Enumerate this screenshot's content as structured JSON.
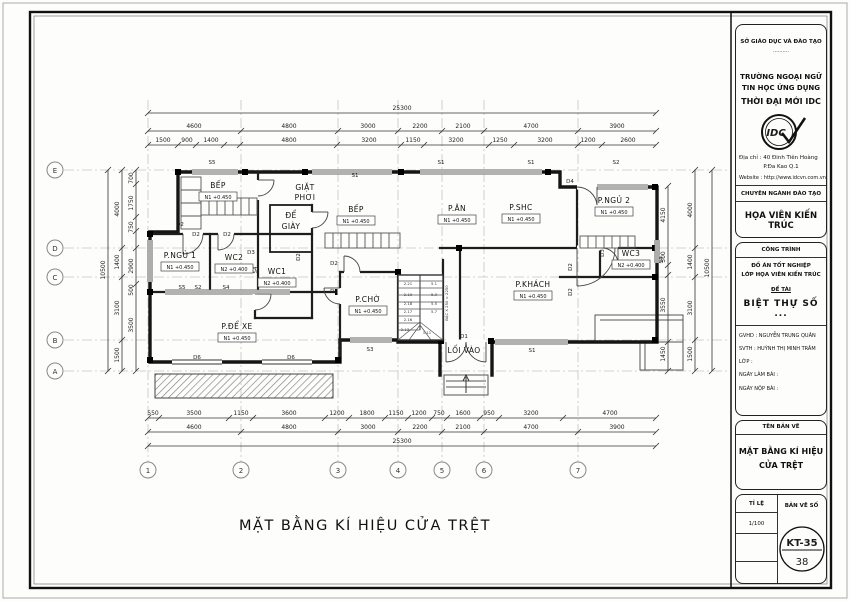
{
  "sheet": {
    "drawing_title": "MẶT BẰNG KÍ HIỆU CỬA TRỆT"
  },
  "title_block": {
    "dept": "SỞ GIÁO DỤC VÀ ĐÀO TẠO",
    "dots": "..........",
    "school_line1": "TRƯỜNG NGOẠI NGỮ",
    "school_line2": "TIN HỌC ỨNG DỤNG",
    "school_line3": "THỜI ĐẠI MỚI IDC",
    "logo_text": "IDC",
    "address_line1": "Địa chỉ : 40 Đinh Tiên Hoàng",
    "address_line2": "P.Đa Kao    Q.1",
    "website": "Website : http://www.idcvn.com.vn",
    "major_header": "CHUYÊN NGÀNH ĐÀO TẠO",
    "major": "HỌA VIÊN KIẾN TRÚC",
    "project_header": "CÔNG TRÌNH",
    "project_line1": "ĐỒ ÁN TỐT NGHIỆP",
    "project_line2": "LỚP HỌA VIÊN KIẾN TRÚC",
    "topic_header": "ĐỀ TÀI",
    "topic": "BIỆT THỰ SỐ ...",
    "gvhd": "GVHD   : NGUYỄN TRUNG QUÂN",
    "svth": "SVTH   : HUỲNH THỊ MINH TRÂM",
    "lop": "LỚP      :",
    "ngay_lam": "NGÀY LÀM BÀI  :",
    "ngay_nop": "NGÀY NỘP BÀI  :",
    "drawing_name_header": "TÊN BẢN VẼ",
    "drawing_name_line1": "MẶT BẰNG KÍ HIỆU",
    "drawing_name_line2": "CỬA TRỆT",
    "scale_header": "TỈ LỆ",
    "scale": "1/100",
    "sheet_no_header": "BẢN VẼ SỐ",
    "sheet_code": "KT-35",
    "sheet_no": "38"
  },
  "plan": {
    "grid": {
      "cols": [
        "1",
        "2",
        "3",
        "4",
        "5",
        "6",
        "7"
      ],
      "rows": [
        "E",
        "D",
        "C",
        "B",
        "A"
      ]
    },
    "dims": {
      "total": "25300",
      "cols": [
        "4600",
        "4800",
        "3000",
        "2200",
        "2100",
        "4700",
        "3900"
      ],
      "top3": [
        "1500",
        "900",
        "1400",
        "4800",
        "3200",
        "1150",
        "3200",
        "1250",
        "3200",
        "1200",
        "2600"
      ],
      "bottom1": [
        "550",
        "3500",
        "1150",
        "3600",
        "1200",
        "1800",
        "1150",
        "1200",
        "750",
        "1600",
        "950",
        "3200",
        "4700"
      ],
      "left_outer": "10500",
      "left_mid": [
        "4000",
        "1400",
        "3100",
        "1500"
      ],
      "left_inner": [
        "700",
        "1750",
        "750",
        "2900",
        "500",
        "3500"
      ],
      "right_outer": "10500",
      "right_inner": [
        "4150",
        "500",
        "3550",
        "1450"
      ]
    },
    "rooms": [
      {
        "label": "BẾP",
        "level": "N1 +0.450"
      },
      {
        "label": "GIẶT",
        "l2": "PHƠI"
      },
      {
        "label": "ĐỂ",
        "l2": "GIÀY"
      },
      {
        "label": "BẾP",
        "level": "N1 +0.450"
      },
      {
        "label": "P.ĂN",
        "level": "N1 +0.450"
      },
      {
        "label": "P.SHC",
        "level": "N1 +0.450"
      },
      {
        "label": "P.NGỦ 2",
        "level": "N1 +0.450"
      },
      {
        "label": "P.NGỦ 1",
        "level": "N1 +0.450"
      },
      {
        "label": "WC2",
        "level": "N2 +0.400"
      },
      {
        "label": "WC1",
        "level": "N2 +0.400"
      },
      {
        "label": "WC3",
        "level": "N2 +0.400"
      },
      {
        "label": "P.CHỜ",
        "level": "N1 +0.450"
      },
      {
        "label": "P.KHÁCH",
        "level": "N1 +0.450"
      },
      {
        "label": "P.ĐỂ XE",
        "level": "N1 +0.450"
      },
      {
        "label": "LỐI VÀO"
      }
    ],
    "tags": [
      {
        "t": "S5"
      },
      {
        "t": "S1"
      },
      {
        "t": "S1"
      },
      {
        "t": "S1"
      },
      {
        "t": "S2"
      },
      {
        "t": "D4"
      },
      {
        "t": "D2"
      },
      {
        "t": "D2"
      },
      {
        "t": "D2"
      },
      {
        "t": "D3"
      },
      {
        "t": "S4"
      },
      {
        "t": "D2"
      },
      {
        "t": "S5"
      },
      {
        "t": "S2"
      },
      {
        "t": "S4"
      },
      {
        "t": "D2"
      },
      {
        "t": "D2"
      },
      {
        "t": "D2"
      },
      {
        "t": "D2"
      },
      {
        "t": "D3"
      },
      {
        "t": "S4"
      },
      {
        "t": "S3"
      },
      {
        "t": "S1"
      },
      {
        "t": "D6"
      },
      {
        "t": "D6"
      },
      {
        "t": "D1"
      }
    ],
    "stair": {
      "note": "BẬC X 250 = 2250",
      "steps": [
        "2.21",
        "2.19",
        "2.18",
        "2.17",
        "2.16",
        "2.13",
        "1.11",
        "5.1",
        "5.3",
        "5.5",
        "5.7"
      ]
    }
  }
}
